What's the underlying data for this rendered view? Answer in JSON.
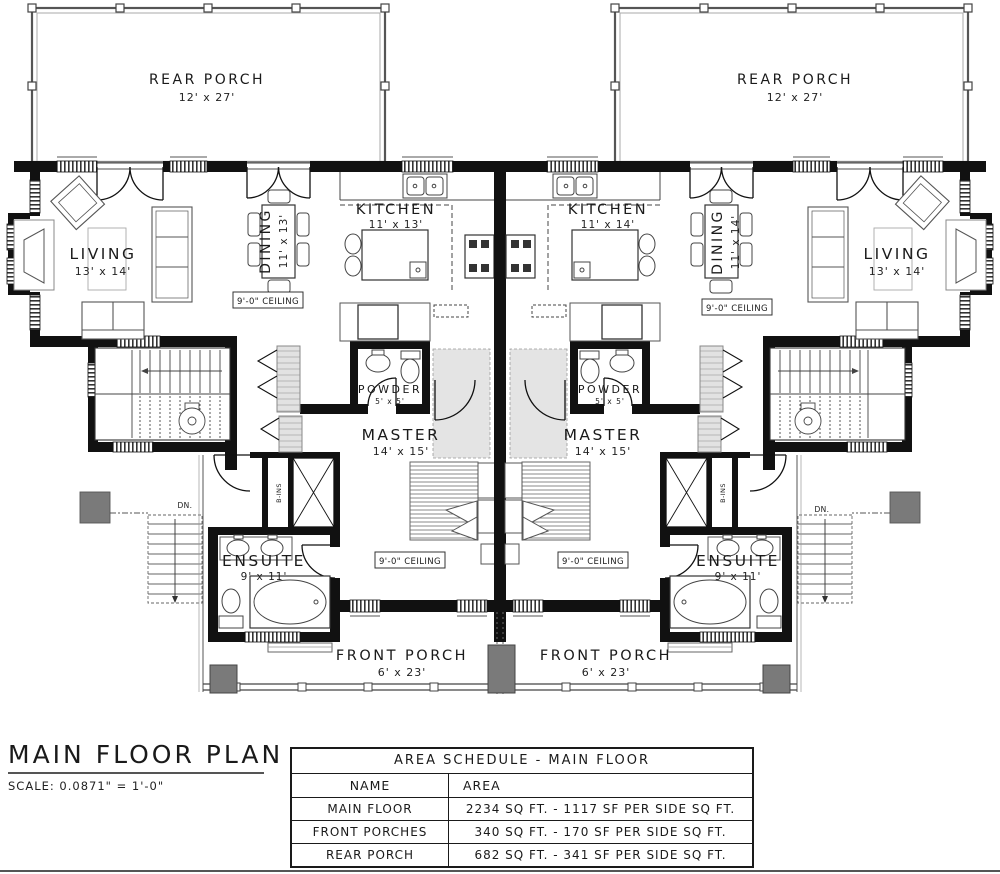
{
  "plan": {
    "title": "MAIN FLOOR PLAN",
    "scale_note": "SCALE: 0.0871\" = 1'-0\"",
    "ceiling_note": "9'-0\" CEILING",
    "stairs_down_note": "DN.",
    "builtins_note": "B-INS"
  },
  "units": {
    "left": {
      "rear_porch": {
        "name": "REAR PORCH",
        "dims": "12' x 27'"
      },
      "living": {
        "name": "LIVING",
        "dims": "13' x 14'"
      },
      "dining": {
        "name": "DINING",
        "dims": "11' x 13'"
      },
      "kitchen": {
        "name": "KITCHEN",
        "dims": "11' x 13'"
      },
      "powder": {
        "name": "POWDER",
        "dims": "5' x 5'"
      },
      "master": {
        "name": "MASTER",
        "dims": "14' x 15'"
      },
      "ensuite": {
        "name": "ENSUITE",
        "dims": "9' x 11'"
      },
      "front_porch": {
        "name": "FRONT PORCH",
        "dims": "6' x 23'"
      }
    },
    "right": {
      "rear_porch": {
        "name": "REAR PORCH",
        "dims": "12' x 27'"
      },
      "living": {
        "name": "LIVING",
        "dims": "13' x 14'"
      },
      "dining": {
        "name": "DINING",
        "dims": "11' x 14'"
      },
      "kitchen": {
        "name": "KITCHEN",
        "dims": "11' x 14'"
      },
      "powder": {
        "name": "POWDER",
        "dims": "5' x 5'"
      },
      "master": {
        "name": "MASTER",
        "dims": "14' x 15'"
      },
      "ensuite": {
        "name": "ENSUITE",
        "dims": "9' x 11'"
      },
      "front_porch": {
        "name": "FRONT PORCH",
        "dims": "6' x 23'"
      }
    }
  },
  "area_schedule": {
    "title": "AREA SCHEDULE - MAIN FLOOR",
    "columns": {
      "name": "NAME",
      "area": "AREA"
    },
    "rows": [
      {
        "name": "MAIN FLOOR",
        "area": "2234 SQ FT. - 1117 SF PER SIDE SQ FT."
      },
      {
        "name": "FRONT PORCHES",
        "area": "340 SQ FT. - 170 SF PER SIDE SQ FT."
      },
      {
        "name": "REAR PORCH",
        "area": "682 SQ FT. - 341 SF PER SIDE SQ FT."
      }
    ]
  },
  "colors": {
    "wall": "#111111",
    "porch_concrete": "#7a7a7a",
    "hall_tile": "#e4e4e4",
    "paper": "#ffffff"
  }
}
